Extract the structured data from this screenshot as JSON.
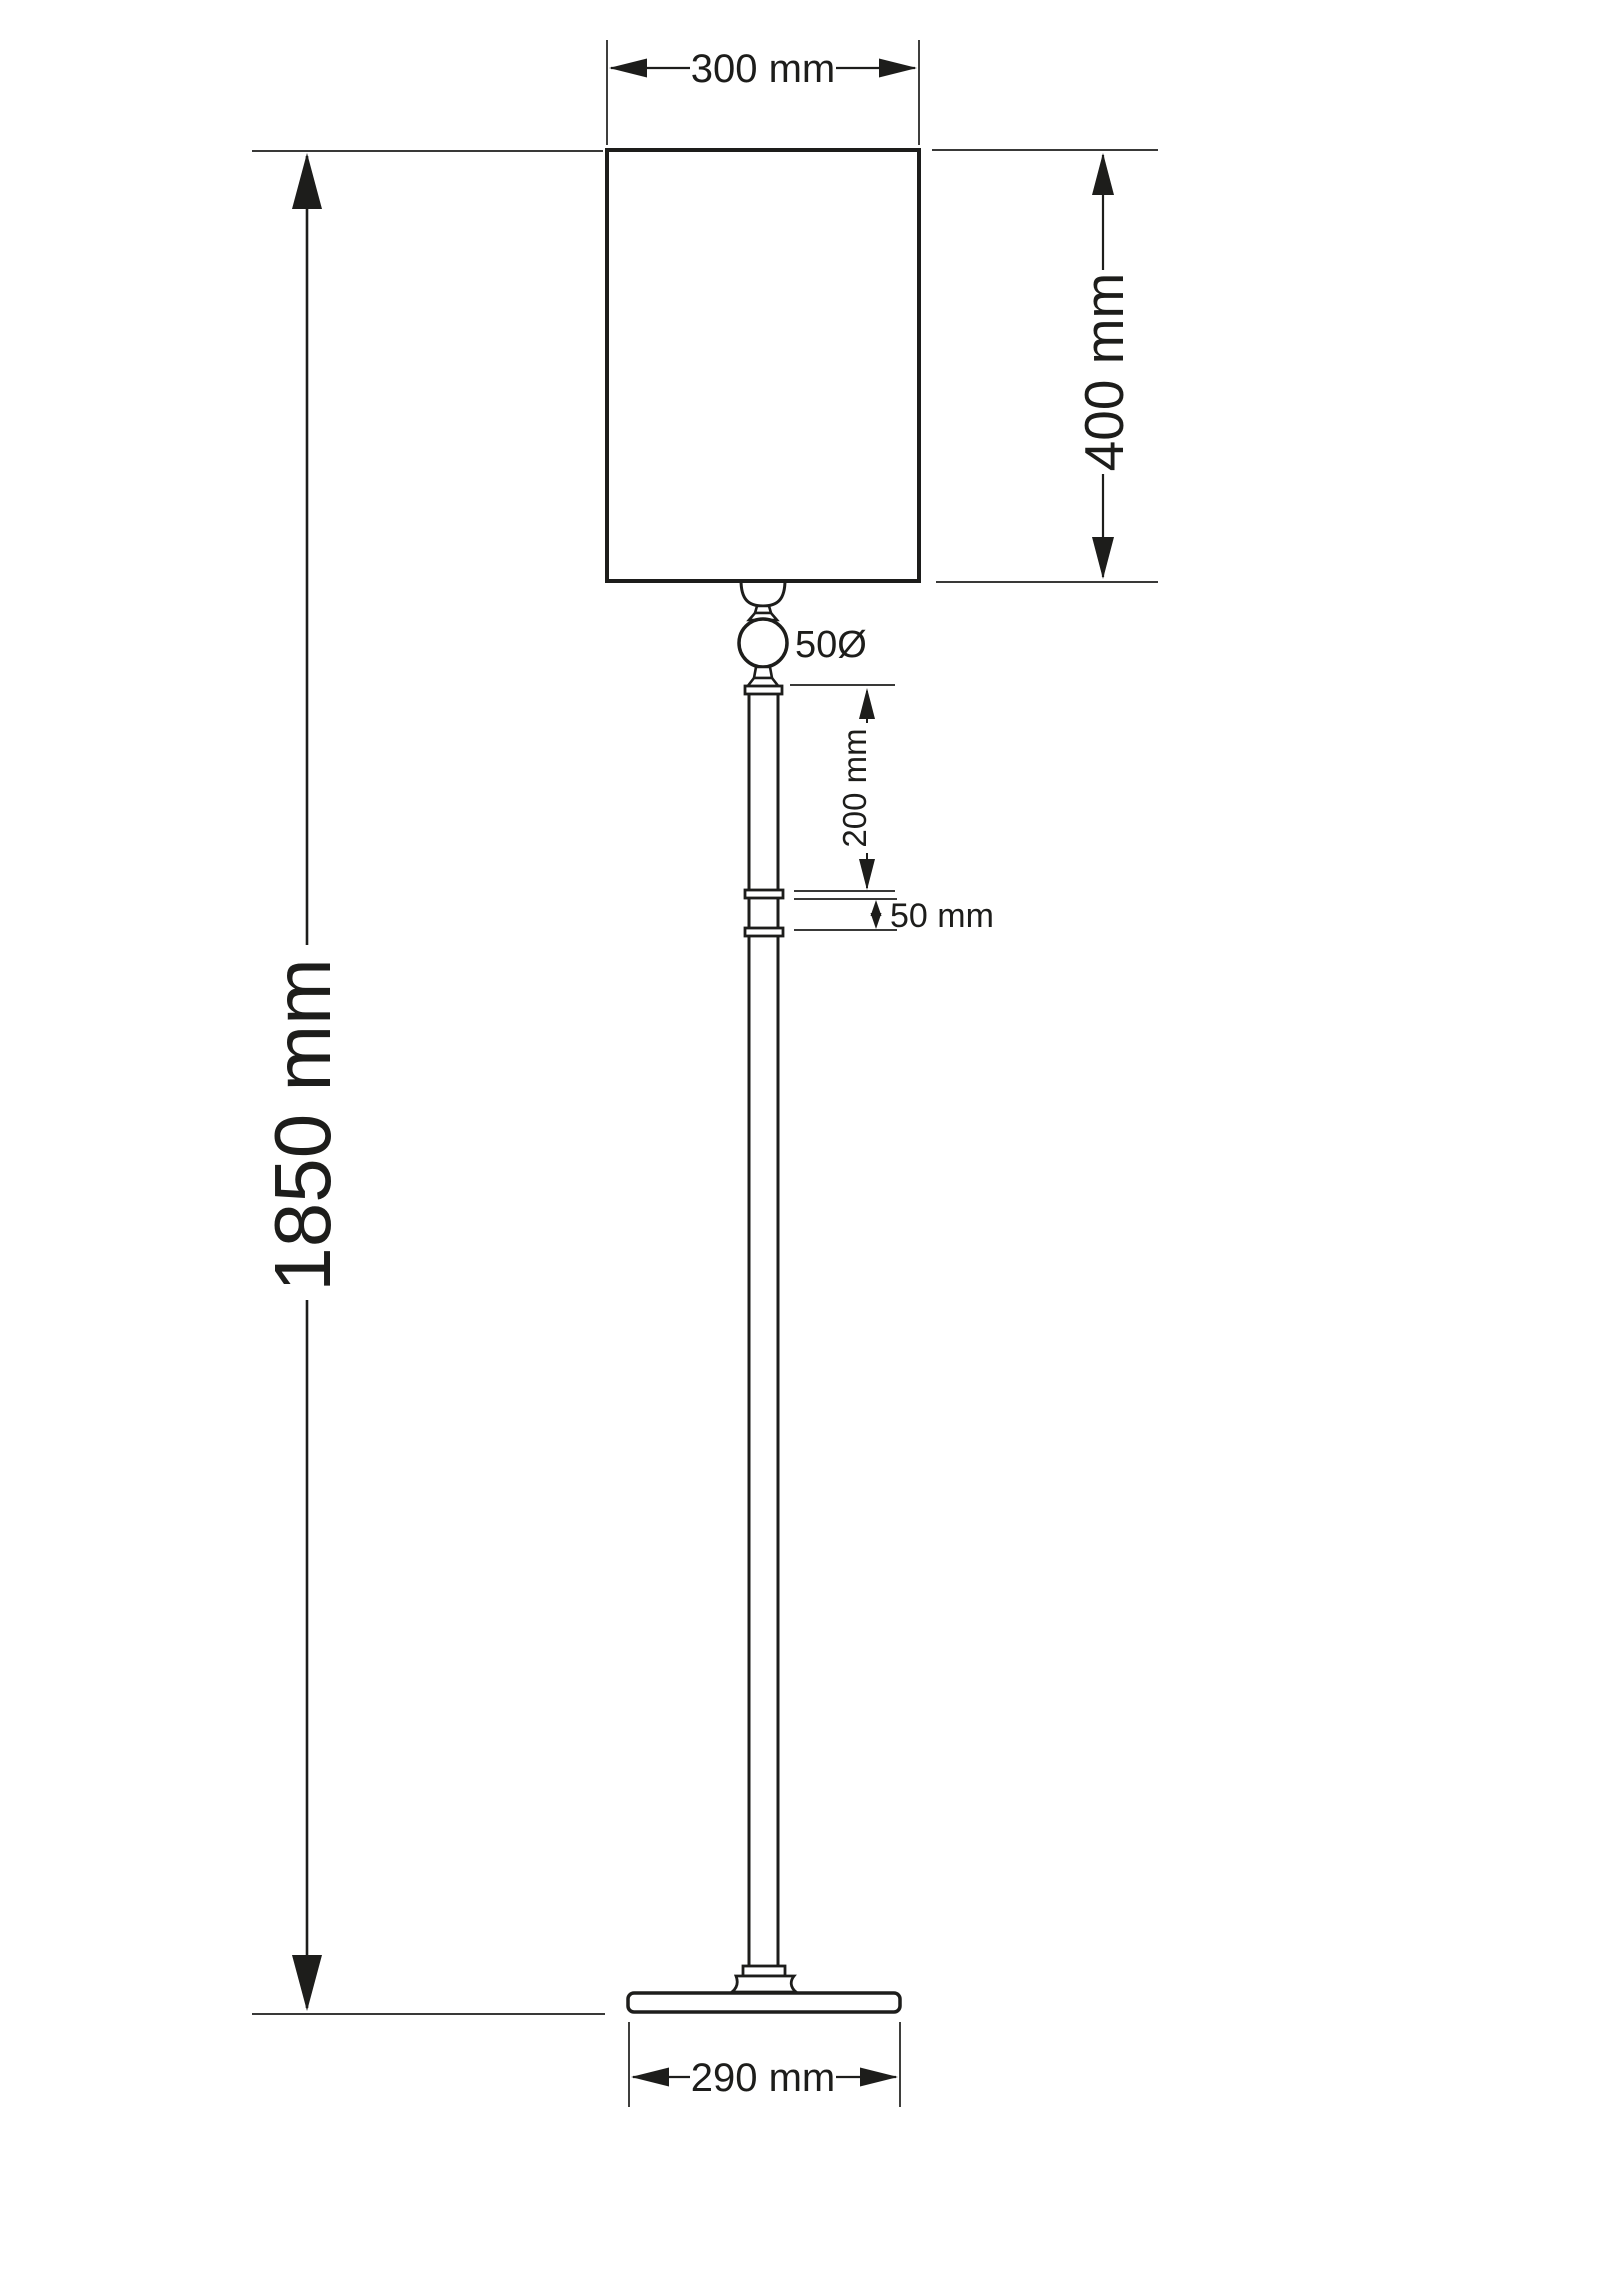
{
  "colors": {
    "background": "#ffffff",
    "line": "#1d1d1b"
  },
  "dimensions": {
    "shade_width": {
      "label": "300 mm"
    },
    "shade_height": {
      "label": "400 mm"
    },
    "ball_diameter": {
      "label": "50Ø"
    },
    "upper_pole_length": {
      "label": "200 mm"
    },
    "joint_length": {
      "label": "50 mm"
    },
    "total_height": {
      "label": "1850 mm"
    },
    "base_width": {
      "label": "290 mm"
    }
  }
}
